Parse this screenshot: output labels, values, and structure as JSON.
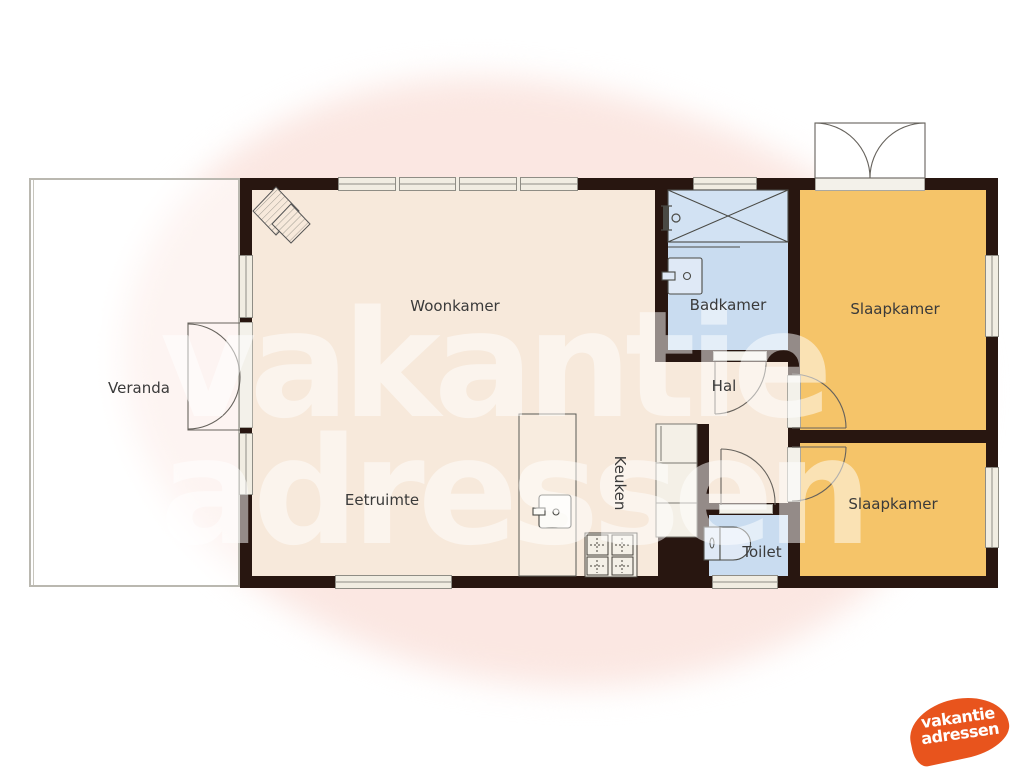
{
  "plan": {
    "type": "floorplan",
    "rooms": {
      "woonkamer": {
        "label": "Woonkamer",
        "color": "#f7e9db"
      },
      "eetruimte": {
        "label": "Eetruimte",
        "color": "#f7e9db"
      },
      "keuken": {
        "label": "Keuken",
        "color": "#f7e9db"
      },
      "hal": {
        "label": "Hal",
        "color": "#f7e9db"
      },
      "badkamer": {
        "label": "Badkamer",
        "color": "#c9dcf0"
      },
      "toilet": {
        "label": "Toilet",
        "color": "#c9dcf0"
      },
      "slaapkamer_1": {
        "label": "Slaapkamer",
        "color": "#f5c469"
      },
      "slaapkamer_2": {
        "label": "Slaapkamer",
        "color": "#f5c469"
      },
      "veranda": {
        "label": "Veranda",
        "color": "#ffffff"
      }
    },
    "fixtures": [
      "fireplace",
      "shower",
      "shower-head",
      "washbasin",
      "toilet-bowl",
      "kitchen-island",
      "sink",
      "stove-4-burners",
      "kitchen-counters",
      "double-entry-door",
      "double-veranda-door",
      "4-interior-doors"
    ],
    "wall_color": "#281610",
    "window_color": "#f1ede2"
  },
  "watermark": {
    "line1": "vakantie",
    "line2": "adressen",
    "color": "rgba(255,255,255,0.5)"
  },
  "logo": {
    "line1": "vakantie",
    "line2": "adressen",
    "blob_color": "#e8541d",
    "text_color": "#ffffff"
  }
}
